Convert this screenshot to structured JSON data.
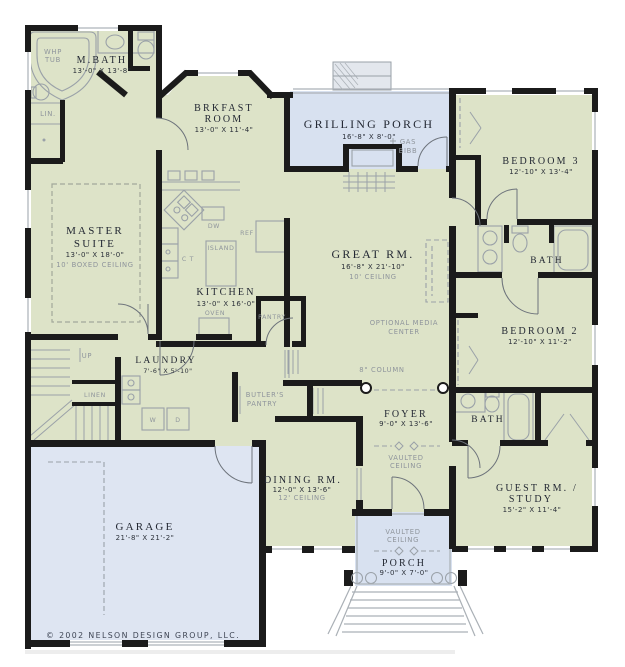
{
  "plan": {
    "copyright": "© 2002 NELSON DESIGN GROUP, LLC.",
    "colors": {
      "floor_green": "#dde3c8",
      "porch_blue": "#d8e1f0",
      "garage_blue": "#dee5f2",
      "wall_black": "#1b1b1b",
      "fixture_gray": "#9aa1a8",
      "note_gray": "#8f959c",
      "title_ink": "#232833"
    },
    "rooms": {
      "mbath": {
        "name": "M.BATH",
        "dim": "13'-0\" X 13'-8\""
      },
      "whp": {
        "l1": "WHP",
        "l2": "TUB"
      },
      "lin": {
        "label": "LIN."
      },
      "master": {
        "name1": "MASTER",
        "name2": "SUITE",
        "dim": "13'-0\" X 18'-0\"",
        "note": "10' BOXED CEILING"
      },
      "brkfast": {
        "name1": "BRKFAST",
        "name2": "ROOM",
        "dim": "13'-0\" X 11'-4\""
      },
      "grill": {
        "name": "GRILLING PORCH",
        "dim": "16'-8\" X 8'-0\"",
        "gas1": "GAS",
        "gas2": "BIBB"
      },
      "bed3": {
        "name": "BEDROOM 3",
        "dim": "12'-10\" X 13'-4\""
      },
      "bath1": {
        "name": "BATH"
      },
      "bed2": {
        "name": "BEDROOM 2",
        "dim": "12'-10\" X 11'-2\""
      },
      "great": {
        "name": "GREAT RM.",
        "dim": "16'-8\" X 21'-10\"",
        "note": "10' CEILING",
        "media1": "OPTIONAL MEDIA",
        "media2": "CENTER",
        "column": "8\" COLUMN"
      },
      "kitchen": {
        "name": "KITCHEN",
        "dim": "13'-0\" X 16'-0\"",
        "island": "ISLAND",
        "ref": "REF",
        "dw": "DW",
        "oven": "OVEN",
        "pantry": "PANTRY",
        "ct": "C T"
      },
      "laundry": {
        "name": "LAUNDRY",
        "dim": "7'-6\" X 5'-10\"",
        "up": "UP",
        "linen": "LINEN",
        "w": "W",
        "d": "D"
      },
      "butler": {
        "l1": "BUTLER'S",
        "l2": "PANTRY"
      },
      "foyer": {
        "name": "FOYER",
        "dim": "9'-0\" X 13'-6\"",
        "v1": "VAULTED",
        "v2": "CEILING"
      },
      "dining": {
        "name": "DINING RM.",
        "dim": "12'-0\" X 13'-6\"",
        "note": "12' CEILING"
      },
      "bath2": {
        "name": "BATH"
      },
      "guest": {
        "name1": "GUEST RM. /",
        "name2": "STUDY",
        "dim": "15'-2\" X 11'-4\""
      },
      "garage": {
        "name": "GARAGE",
        "dim": "21'-8\" X 21'-2\""
      },
      "porch": {
        "name": "PORCH",
        "dim": "9'-0\" X 7'-0\"",
        "v1": "VAULTED",
        "v2": "CEILING"
      }
    }
  }
}
